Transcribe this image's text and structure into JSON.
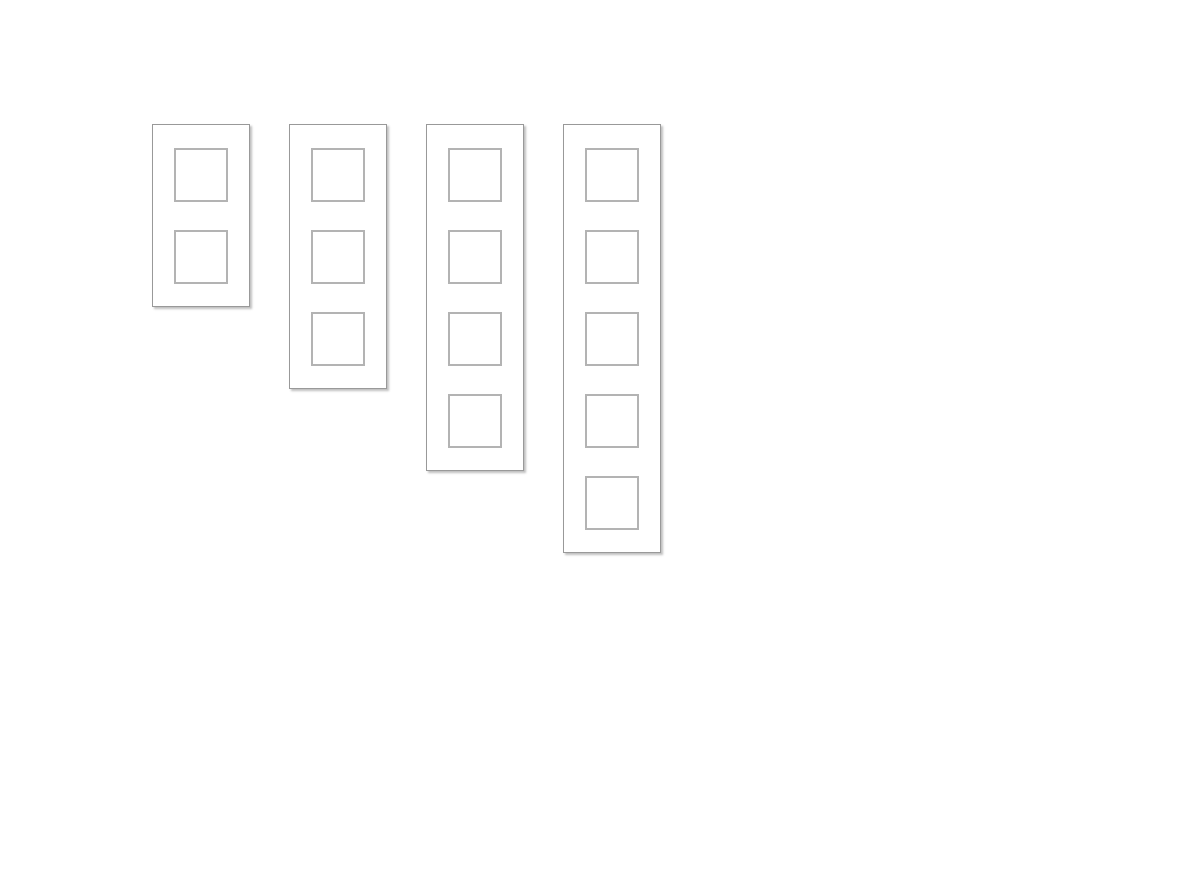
{
  "board": {
    "description": "row of empty card panels",
    "panels": [
      {
        "id": "panel-1",
        "slot_count": 2
      },
      {
        "id": "panel-2",
        "slot_count": 3
      },
      {
        "id": "panel-3",
        "slot_count": 4
      },
      {
        "id": "panel-4",
        "slot_count": 5
      }
    ]
  },
  "colors": {
    "page_background": "#ffffff",
    "panel_background": "#ffffff",
    "panel_border": "#999999",
    "panel_shadow": "#bfbfbf",
    "slot_background": "#ffffff",
    "slot_border": "#b3b3b3"
  }
}
